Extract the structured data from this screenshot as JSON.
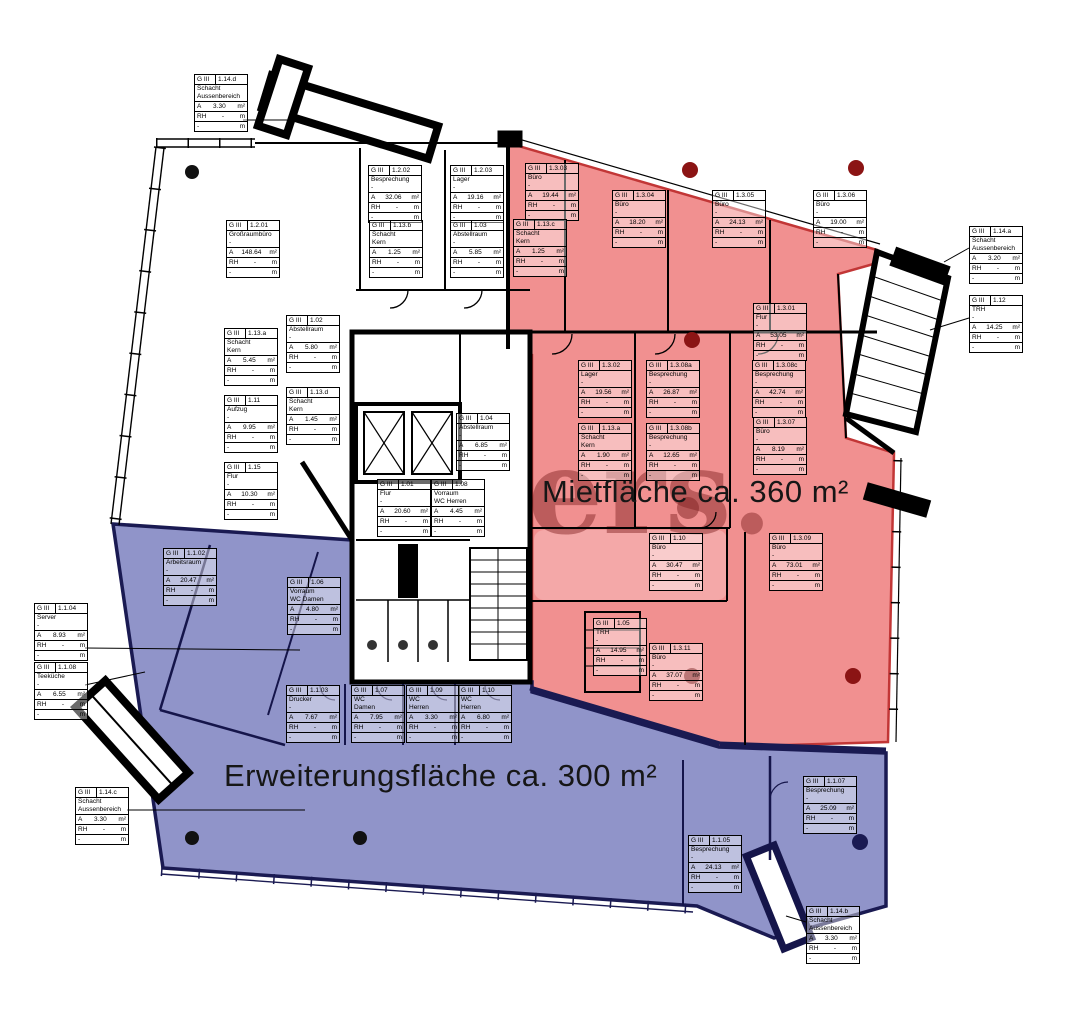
{
  "plan": {
    "watermark": "liers.",
    "zones": {
      "miet": {
        "label": "Mietfläche ca. 360 m²",
        "color": "#f19090",
        "border": "#c23636"
      },
      "erweiterung": {
        "label": "Erweiterungsfläche ca. 300 m²",
        "color": "#9094c9",
        "border": "#1a1a52"
      }
    },
    "box": {
      "prefix": "G III",
      "area_label": "A",
      "area_unit": "m²",
      "rh_label": "RH",
      "rh_value": "-",
      "rh_unit": "m",
      "dash": "-"
    },
    "rooms": [
      {
        "code": "1.14.d",
        "lines": [
          "Schacht",
          "Aussenbereich"
        ],
        "area": "3.30",
        "x": 194,
        "y": 74
      },
      {
        "code": "1.2.02",
        "lines": [
          "Besprechung",
          "-"
        ],
        "area": "32.06",
        "x": 368,
        "y": 165
      },
      {
        "code": "1.2.03",
        "lines": [
          "Lager",
          "-"
        ],
        "area": "19.16",
        "x": 450,
        "y": 165
      },
      {
        "code": "1.2.01",
        "lines": [
          "Großraumbüro",
          "-"
        ],
        "area": "148.64",
        "x": 226,
        "y": 220
      },
      {
        "code": "1.13.b",
        "lines": [
          "Schacht",
          "Kern"
        ],
        "area": "1.25",
        "x": 369,
        "y": 220
      },
      {
        "code": "1.03",
        "lines": [
          "Abstellraum",
          "-"
        ],
        "area": "5.85",
        "x": 450,
        "y": 220
      },
      {
        "code": "1.3.03",
        "lines": [
          "Büro",
          "-"
        ],
        "area": "19.44",
        "x": 525,
        "y": 163
      },
      {
        "code": "1.13.c",
        "lines": [
          "Schacht",
          "Kern"
        ],
        "area": "1.25",
        "x": 513,
        "y": 219
      },
      {
        "code": "1.3.04",
        "lines": [
          "Büro",
          "-"
        ],
        "area": "18.20",
        "x": 612,
        "y": 190
      },
      {
        "code": "1.3.05",
        "lines": [
          "Büro",
          "-"
        ],
        "area": "24.13",
        "x": 712,
        "y": 190
      },
      {
        "code": "1.3.06",
        "lines": [
          "Büro",
          "-"
        ],
        "area": "19.00",
        "x": 813,
        "y": 190
      },
      {
        "code": "1.14.a",
        "lines": [
          "Schacht",
          "Aussenbereich"
        ],
        "area": "3.20",
        "x": 969,
        "y": 226
      },
      {
        "code": "1.12",
        "lines": [
          "TRH",
          "-"
        ],
        "area": "14.25",
        "x": 969,
        "y": 295
      },
      {
        "code": "1.13.a",
        "lines": [
          "Schacht",
          "Kern"
        ],
        "area": "5.45",
        "x": 224,
        "y": 328
      },
      {
        "code": "1.02",
        "lines": [
          "Abstellraum",
          "-"
        ],
        "area": "5.80",
        "x": 286,
        "y": 315
      },
      {
        "code": "1.11",
        "lines": [
          "Aufzug",
          "-"
        ],
        "area": "9.95",
        "x": 224,
        "y": 395
      },
      {
        "code": "1.13.d",
        "lines": [
          "Schacht",
          "Kern"
        ],
        "area": "1.45",
        "x": 286,
        "y": 387
      },
      {
        "code": "1.15",
        "lines": [
          "Flur",
          "-"
        ],
        "area": "10.30",
        "x": 224,
        "y": 462
      },
      {
        "code": "1.3.01",
        "lines": [
          "Flur",
          "-"
        ],
        "area": "53.05",
        "x": 753,
        "y": 303
      },
      {
        "code": "1.3.02",
        "lines": [
          "Lager",
          "-"
        ],
        "area": "19.56",
        "x": 578,
        "y": 360
      },
      {
        "code": "1.3.08a",
        "lines": [
          "Besprechung",
          "-"
        ],
        "area": "26.87",
        "x": 646,
        "y": 360
      },
      {
        "code": "1.3.08c",
        "lines": [
          "Besprechung",
          "-"
        ],
        "area": "42.74",
        "x": 752,
        "y": 360
      },
      {
        "code": "1.13.a",
        "lines": [
          "Schacht",
          "Kern"
        ],
        "area": "1.90",
        "x": 578,
        "y": 423
      },
      {
        "code": "1.3.08b",
        "lines": [
          "Besprechung",
          "-"
        ],
        "area": "12.65",
        "x": 646,
        "y": 423
      },
      {
        "code": "1.3.07",
        "lines": [
          "Büro",
          "-"
        ],
        "area": "8.19",
        "x": 753,
        "y": 417
      },
      {
        "code": "1.04",
        "lines": [
          "Abstellraum",
          "-"
        ],
        "area": "6.85",
        "x": 456,
        "y": 413
      },
      {
        "code": "1.01",
        "lines": [
          "Flur",
          "-"
        ],
        "area": "20.60",
        "x": 377,
        "y": 479
      },
      {
        "code": "1.08",
        "lines": [
          "Vorraum",
          "WC Herren"
        ],
        "area": "4.45",
        "x": 431,
        "y": 479
      },
      {
        "code": "1.1.02",
        "lines": [
          "Arbeitsraum",
          "-"
        ],
        "area": "20.47",
        "x": 163,
        "y": 548
      },
      {
        "code": "1.06",
        "lines": [
          "Vorraum",
          "WC Damen"
        ],
        "area": "4.80",
        "x": 287,
        "y": 577
      },
      {
        "code": "1.1.04",
        "lines": [
          "Server",
          "-"
        ],
        "area": "8.93",
        "x": 34,
        "y": 603
      },
      {
        "code": "1.1.08",
        "lines": [
          "Teeküche",
          "-"
        ],
        "area": "6.55",
        "x": 34,
        "y": 662
      },
      {
        "code": "1.10",
        "lines": [
          "Büro",
          "-"
        ],
        "area": "30.47",
        "x": 649,
        "y": 533
      },
      {
        "code": "1.3.09",
        "lines": [
          "Büro",
          "-"
        ],
        "area": "73.01",
        "x": 769,
        "y": 533
      },
      {
        "code": "1.05",
        "lines": [
          "TRH",
          "-"
        ],
        "area": "14.95",
        "x": 593,
        "y": 618
      },
      {
        "code": "1.3.11",
        "lines": [
          "Büro",
          "-"
        ],
        "area": "37.07",
        "x": 649,
        "y": 643
      },
      {
        "code": "1.1.03",
        "lines": [
          "Drucker",
          "-"
        ],
        "area": "7.67",
        "x": 286,
        "y": 685
      },
      {
        "code": "1.07",
        "lines": [
          "WC",
          "Damen"
        ],
        "area": "7.95",
        "x": 351,
        "y": 685
      },
      {
        "code": "1.09",
        "lines": [
          "WC",
          "Herren"
        ],
        "area": "3.30",
        "x": 406,
        "y": 685
      },
      {
        "code": "1.10",
        "lines": [
          "WC",
          "Herren"
        ],
        "area": "6.80",
        "x": 458,
        "y": 685
      },
      {
        "code": "1.1.07",
        "lines": [
          "Besprechung",
          "-"
        ],
        "area": "25.09",
        "x": 803,
        "y": 776
      },
      {
        "code": "1.1.05",
        "lines": [
          "Besprechung",
          "-"
        ],
        "area": "24.13",
        "x": 688,
        "y": 835
      },
      {
        "code": "1.14.c",
        "lines": [
          "Schacht",
          "Aussenbereich"
        ],
        "area": "3.30",
        "x": 75,
        "y": 787
      },
      {
        "code": "1.14.b",
        "lines": [
          "Schacht",
          "Aussenbereich"
        ],
        "area": "3.30",
        "x": 806,
        "y": 906
      }
    ]
  }
}
